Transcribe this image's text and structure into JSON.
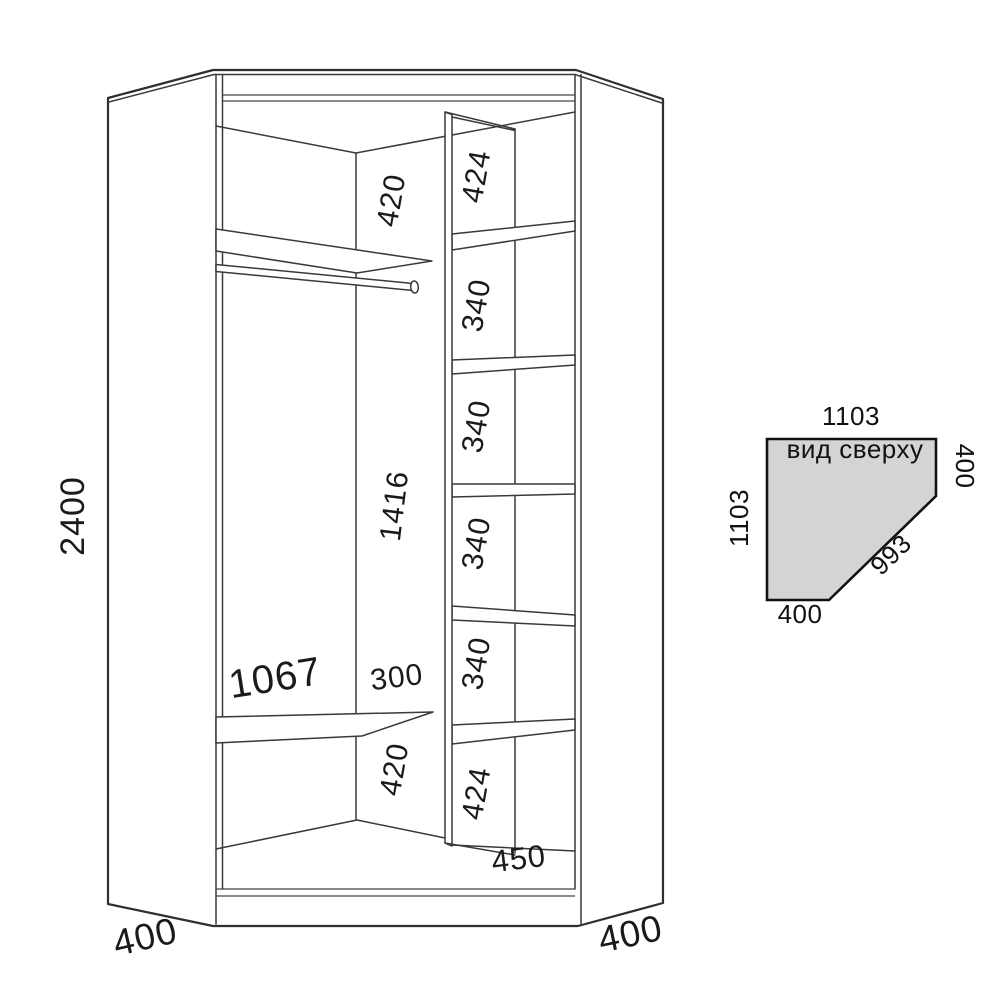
{
  "front_view": {
    "overall_height": "2400",
    "left_base_width": "400",
    "right_base_width": "400",
    "left_section": {
      "top_shelf_gap": "420",
      "hanging_space_height": "1416",
      "lower_shelf_length": "1067",
      "lower_shelf_gap": "300",
      "bottom_gap": "420"
    },
    "shelf_column": {
      "cells": [
        "424",
        "340",
        "340",
        "340",
        "340",
        "424"
      ],
      "column_width": "450"
    }
  },
  "top_view": {
    "title": "вид сверху",
    "top_edge": "1103",
    "right_edge": "400",
    "left_edge": "1103",
    "diagonal_edge": "993",
    "bottom_edge": "400"
  },
  "colors": {
    "line": "#3a3a3a",
    "outline": "#2f2f2f",
    "text": "#1a1a1a",
    "top_view_fill": "#d4d4d4",
    "background": "#ffffff"
  }
}
